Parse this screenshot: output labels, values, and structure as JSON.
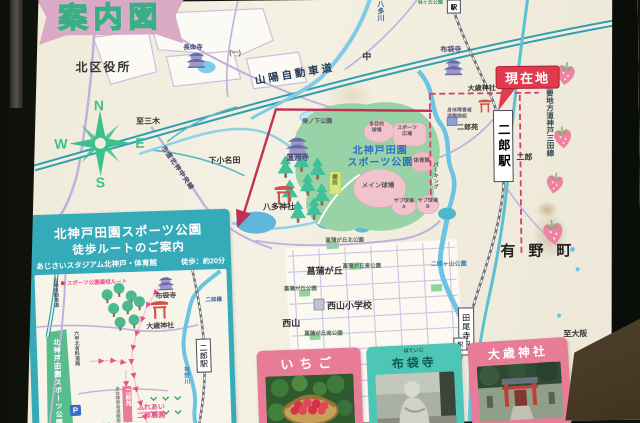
{
  "board": {
    "banner_title": "案内図",
    "compass": {
      "n": "N",
      "e": "E",
      "s": "S",
      "w": "W"
    }
  },
  "labels": {
    "kuyakusho": "北区役所",
    "chomeiji": "長命寺",
    "route_ichi": "(一)",
    "sanyo": "山陽自動車道",
    "naka": "中",
    "hatagawa": "八多川",
    "hayashi_park": "林ヶ丘公園",
    "eki_chip": "駅",
    "hoteiji_map": "布袋寺",
    "genzaichi": "現在地",
    "otoshi_map": "大歳神社",
    "shintai": "身体障害者\n通園施設",
    "jiroen_map": "二郎苑",
    "jiroeki": "二郎駅",
    "kobe_sanda_line": "主要地方道神戸三田線",
    "jiro_area": "二郎",
    "arinocho": "有野町",
    "jirogayama": "二郎ヶ山公園",
    "taojieki": "田尾寺駅",
    "to_osaka": "至大阪",
    "to_miki": "至三木",
    "shimoonada": "下小名田",
    "shido": "市道北神中央線",
    "konoshita": "庚ノ下公園",
    "renshoji": "蓮照寺",
    "hatajinja": "八多神社",
    "tanada": "棚田",
    "park_name": "北神戸田園\nスポーツ公園",
    "tamokuteki": "多目的\n球場",
    "sports_hiroba": "スポーツ\n広場",
    "taiikukan": "体育館",
    "main_ground": "メイン球場",
    "sub_a": "サブ球場\nA",
    "sub_b": "サブ球場\nB",
    "parking": "パーキング",
    "shobugaoka": "菖蒲が丘",
    "shobu_higashi": "菖蒲が丘東公園",
    "shobu_park": "菖蒲が丘公園",
    "shobu_kita": "菖蒲が丘北公園",
    "nishiyama_es": "西山小学校",
    "nishiyama": "西山",
    "shobu_minami": "菖蒲が丘南公園"
  },
  "panel": {
    "title1": "北神戸田園スポーツ公園",
    "title2": "徒歩ルートのご案内",
    "subtitle": "あじさいスタジアム北神戸・体育館",
    "walk_time": "徒歩：約20分",
    "legend": "スポーツ公園最短ルート",
    "labels": {
      "hoteiji": "布袋寺",
      "otoshi": "大歳神社",
      "jirobashi": "二郎橋",
      "jiroeki": "二郎駅",
      "arinogawa": "有野川",
      "sanyo_v": "山陽自動車道",
      "rokko_v": "六甲北有料道路",
      "fureai": "ふれあい\n二郎農園",
      "jiroen_v": "二郎苑",
      "shintai_v": "身体障害者通園施設",
      "strip": "北神戸田園スポーツ公園",
      "p": "P"
    }
  },
  "photos": [
    {
      "title": "いちご"
    },
    {
      "title": "布袋寺",
      "furigana": "ほていじ"
    },
    {
      "title": "大歳神社"
    }
  ],
  "colors": {
    "current_location": "#e03a4e",
    "route_magenta": "#c13059",
    "panel_teal": "#35aab8",
    "panel_pink": "#e87b95",
    "park_green": "#97d3a6",
    "highway_teal": "#2f9fb0",
    "compass_green": "#3cc08d"
  }
}
